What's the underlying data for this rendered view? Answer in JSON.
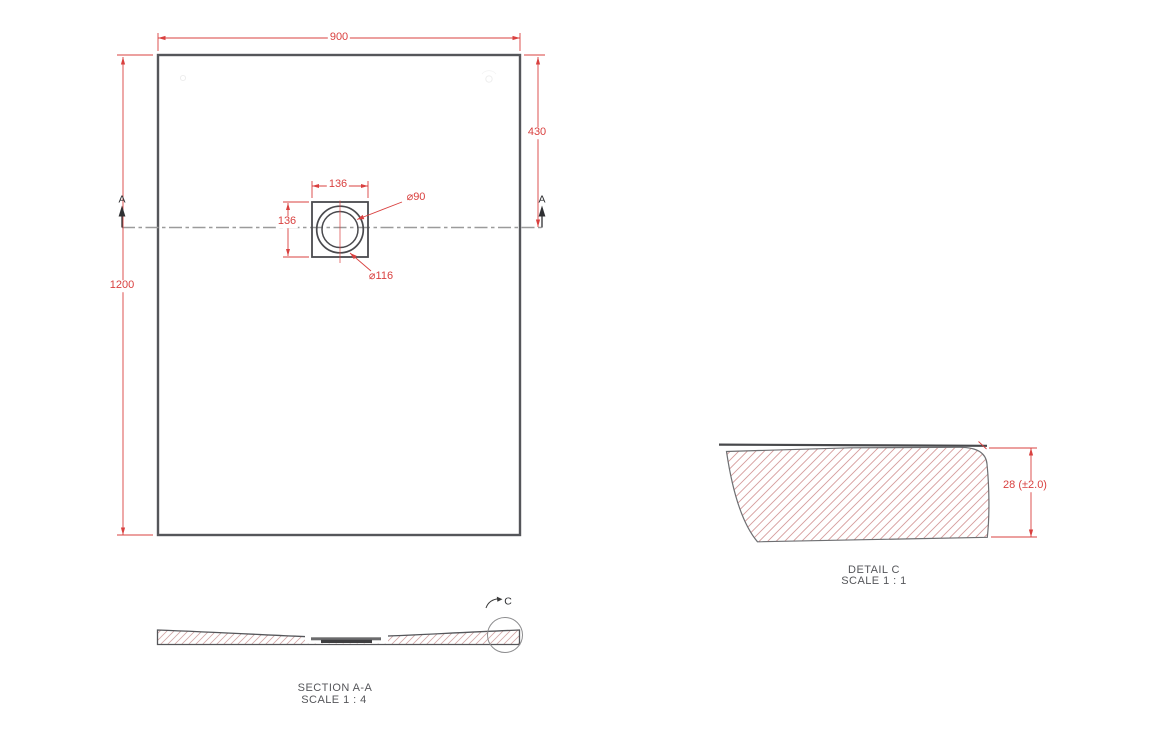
{
  "colors": {
    "dimension_red": "#d9403f",
    "part_edge_gray": "#55565a",
    "hatch_pink": "#d2a1a1",
    "centerline_gray": "#9b9b9b"
  },
  "plan_view": {
    "width_dim": "900",
    "height_dim": "1200",
    "drain_offset_dim": "430",
    "drain_width_dim": "136",
    "drain_height_dim": "136",
    "drain_inner_dia": "⌀90",
    "drain_outer_dia": "⌀116",
    "section_marker_left": "A",
    "section_marker_right": "A"
  },
  "section_view": {
    "title": "SECTION A-A",
    "scale": "SCALE 1 : 4",
    "detail_marker": "C"
  },
  "detail_view": {
    "title": "DETAIL C",
    "scale": "SCALE 1 : 1",
    "thickness_dim": "28 (±2.0)"
  }
}
